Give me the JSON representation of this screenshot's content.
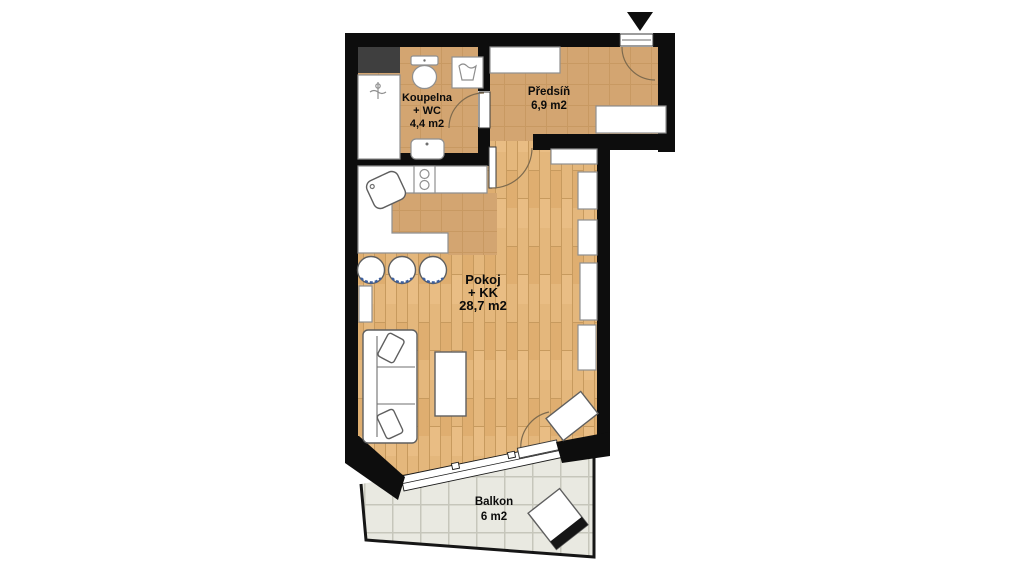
{
  "rooms": {
    "koupelna": {
      "name": "Koupelna",
      "name2": "+ WC",
      "area": "4,4 m2"
    },
    "predsin": {
      "name": "Předsíň",
      "area": "6,9 m2"
    },
    "pokoj": {
      "name": "Pokoj",
      "name2": "+ KK",
      "area": "28,7 m2"
    },
    "balkon": {
      "name": "Balkon",
      "area": "6 m2"
    }
  },
  "icons": {
    "entrance_marker": "triangle-down"
  },
  "colors": {
    "background": "#ffffff",
    "wall": "#0d0d0d",
    "shaft": "#3f3f3f",
    "wood_floor": "#e4b77c",
    "warm_tile": "#d3a571",
    "balcony_tile": "#e9e9e1",
    "furniture": "#ffffff"
  }
}
